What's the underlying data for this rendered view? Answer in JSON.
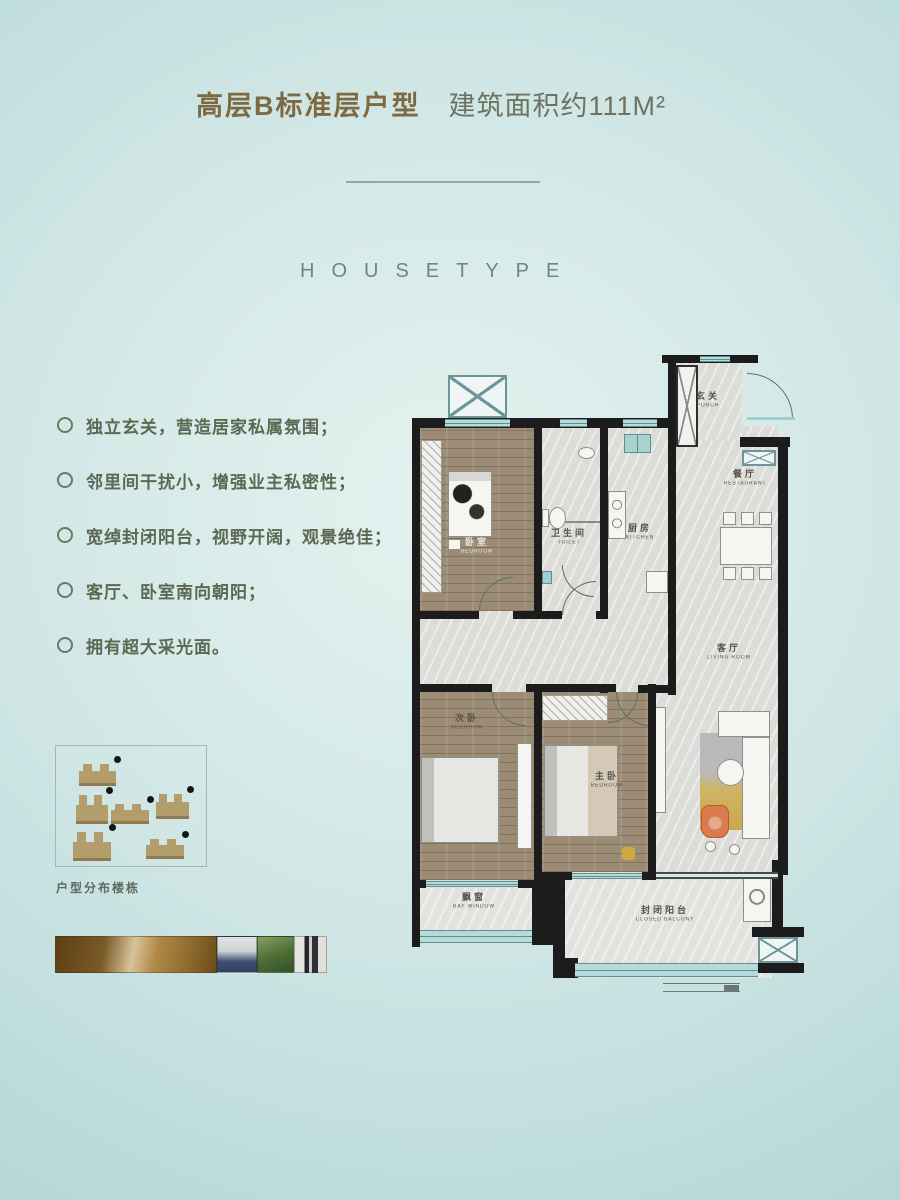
{
  "page": {
    "title": {
      "name_part": "高层B标准层户型",
      "area_part": "建筑面积约111M²"
    },
    "section_heading": "HOUSETYPE"
  },
  "features": {
    "items": [
      "独立玄关，营造居家私属氛围；",
      "邻里间干扰小，增强业主私密性；",
      "宽绰封闭阳台，视野开阔，观景绝佳；",
      "客厅、卧室南向朝阳；",
      "拥有超大采光面。"
    ]
  },
  "floorplan": {
    "rooms": {
      "porch": {
        "zh": "玄关",
        "en": "PORCH"
      },
      "restaurant": {
        "zh": "餐厅",
        "en": "RESTAURANT"
      },
      "toilet": {
        "zh": "卫生间",
        "en": "TOILET"
      },
      "kitchen": {
        "zh": "厨房",
        "en": "KITCHEN"
      },
      "living": {
        "zh": "客厅",
        "en": "LIVING ROOM"
      },
      "bedroom_north": {
        "zh": "卧室",
        "en": "BEDROOM"
      },
      "bedroom_second": {
        "zh": "次卧",
        "en": "BEDROOM"
      },
      "bedroom_master": {
        "zh": "主卧",
        "en": "BEDROOM"
      },
      "bay_window": {
        "zh": "飘窗",
        "en": "BAY WINDOW"
      },
      "closed_balcony": {
        "zh": "封闭阳台",
        "en": "CLOSED BALCONY"
      }
    }
  },
  "legend": {
    "caption": "户型分布楼栋",
    "building_count": 6
  },
  "colors": {
    "title-gold": "#7d6a43",
    "title-sub": "#6d7263",
    "text-olive": "#5c6852",
    "wall-black": "#1c1c1c",
    "window-teal": "#b7dbd8",
    "floor-gray": "#dcdcd8",
    "floor-wood": "#9c8c75",
    "building-tan": "#b39d6c",
    "accent-orange": "#d97b4e",
    "rug-gold": "#c9a544"
  }
}
